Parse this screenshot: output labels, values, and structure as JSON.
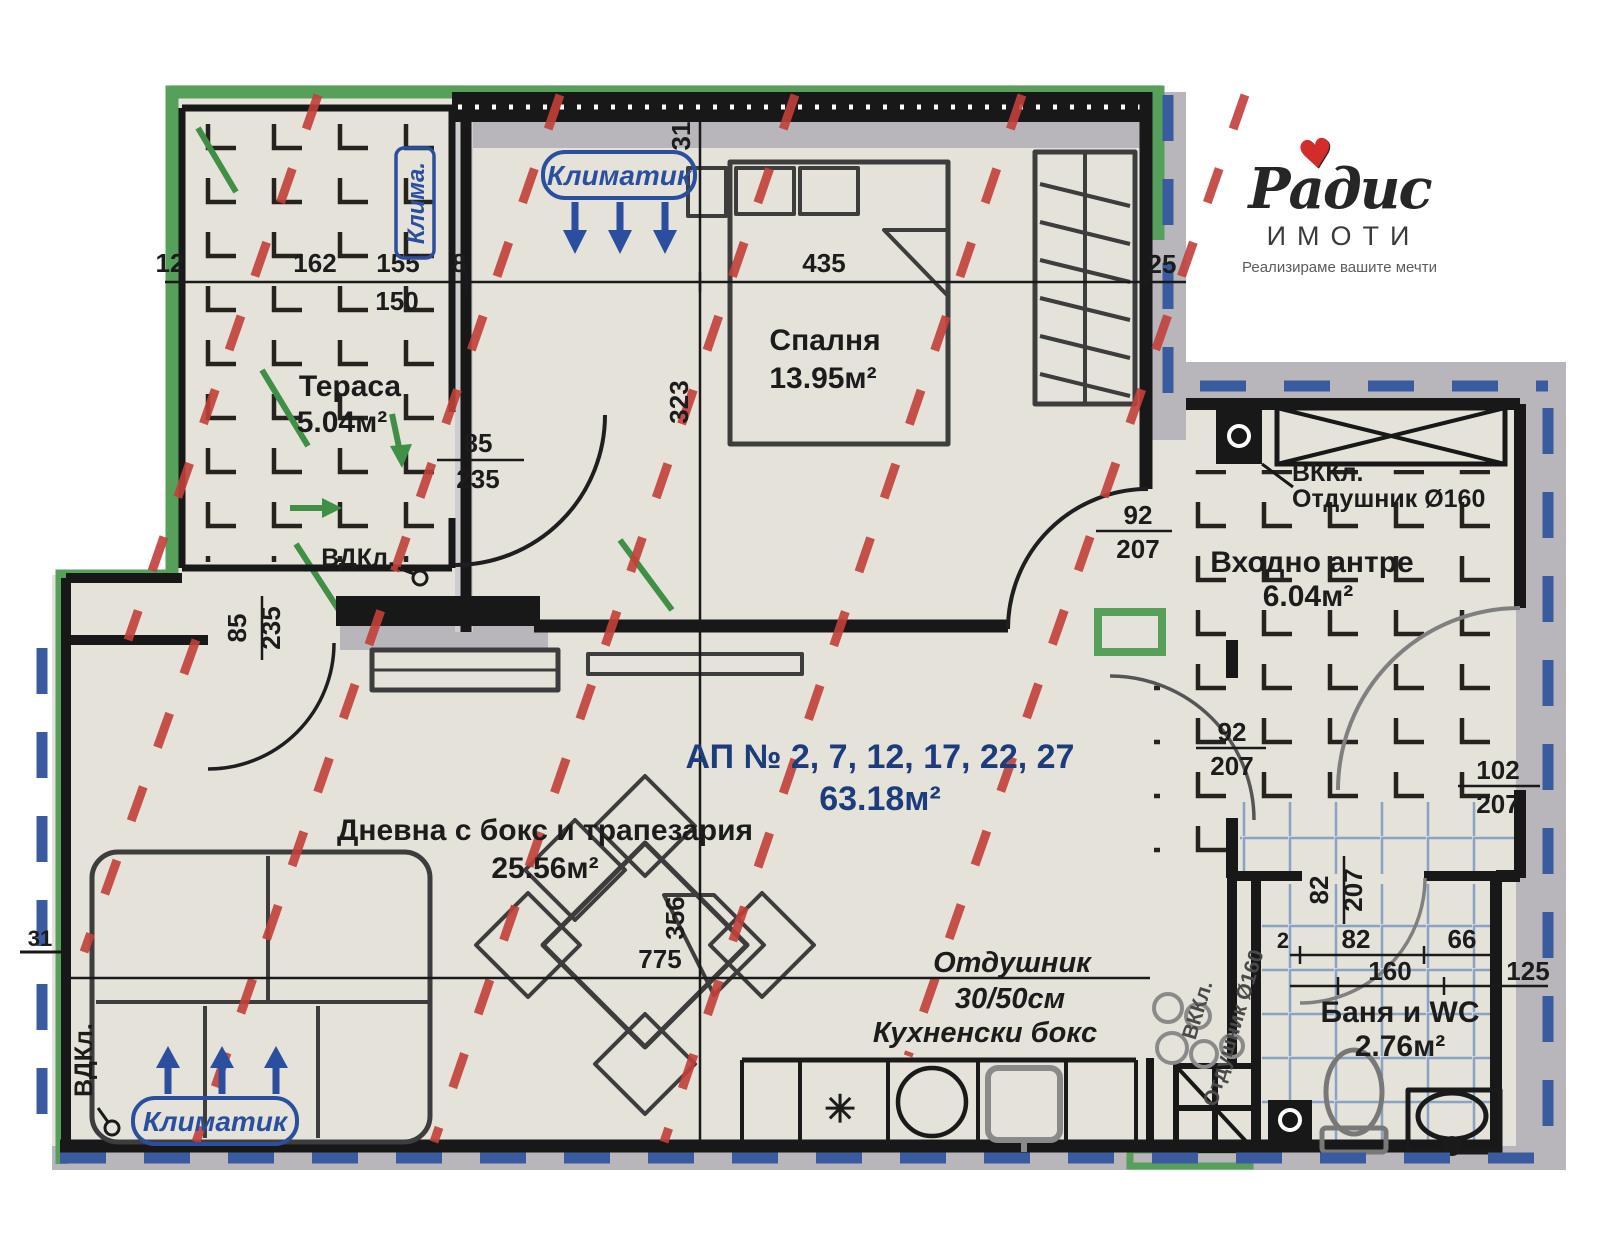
{
  "logo": {
    "brand": "Радис",
    "sub": "ИМОТИ",
    "tagline": "Реализираме вашите мечти",
    "heart": "♥"
  },
  "apartment": {
    "number": "АП № 2, 7, 12, 17, 22, 27",
    "area": "63.18м²"
  },
  "rooms": {
    "terrace": {
      "name": "Тераса",
      "area": "5.04м²"
    },
    "bedroom": {
      "name": "Спалня",
      "area": "13.95м²"
    },
    "living": {
      "name": "Дневна с бокс и трапезария",
      "area": "25.56м²"
    },
    "entry": {
      "name": "Входно антре",
      "area": "6.04м²"
    },
    "bath": {
      "name": "Баня и WC",
      "area": "2.76м²"
    },
    "kitchen": {
      "name": "Кухненски бокс"
    }
  },
  "labels": {
    "ac": "Климатик",
    "ac_short": "Клима.",
    "vdkl": "ВДКл.",
    "vkkl": "ВККл.",
    "vent_d160": "Отдушник Ø160",
    "vent": "Отдушник",
    "vent_size": "30/50см",
    "stove": "✳"
  },
  "dims": {
    "d12": "12",
    "d162": "162",
    "d155": "155",
    "d150": "150",
    "d8": "8",
    "d435": "435",
    "d31": "31",
    "d323": "323",
    "d25": "25",
    "d85": "85",
    "d235": "235",
    "d92": "92",
    "d207": "207",
    "d102": "102",
    "d82": "82",
    "d2": "2",
    "d66": "66",
    "d160": "160",
    "d125": "125",
    "d775": "775",
    "d356": "356"
  },
  "colors": {
    "paper": "#e5e2da",
    "wall": "#181818",
    "gray_band": "#b8b5bb",
    "green": "#56a05c",
    "red_dash": "#c2403a",
    "blue_dash": "#3a5b9f",
    "blue_label": "#2b4f9e",
    "apt_blue": "#1d3c7c",
    "tile_blue": "#8aa3c4"
  }
}
